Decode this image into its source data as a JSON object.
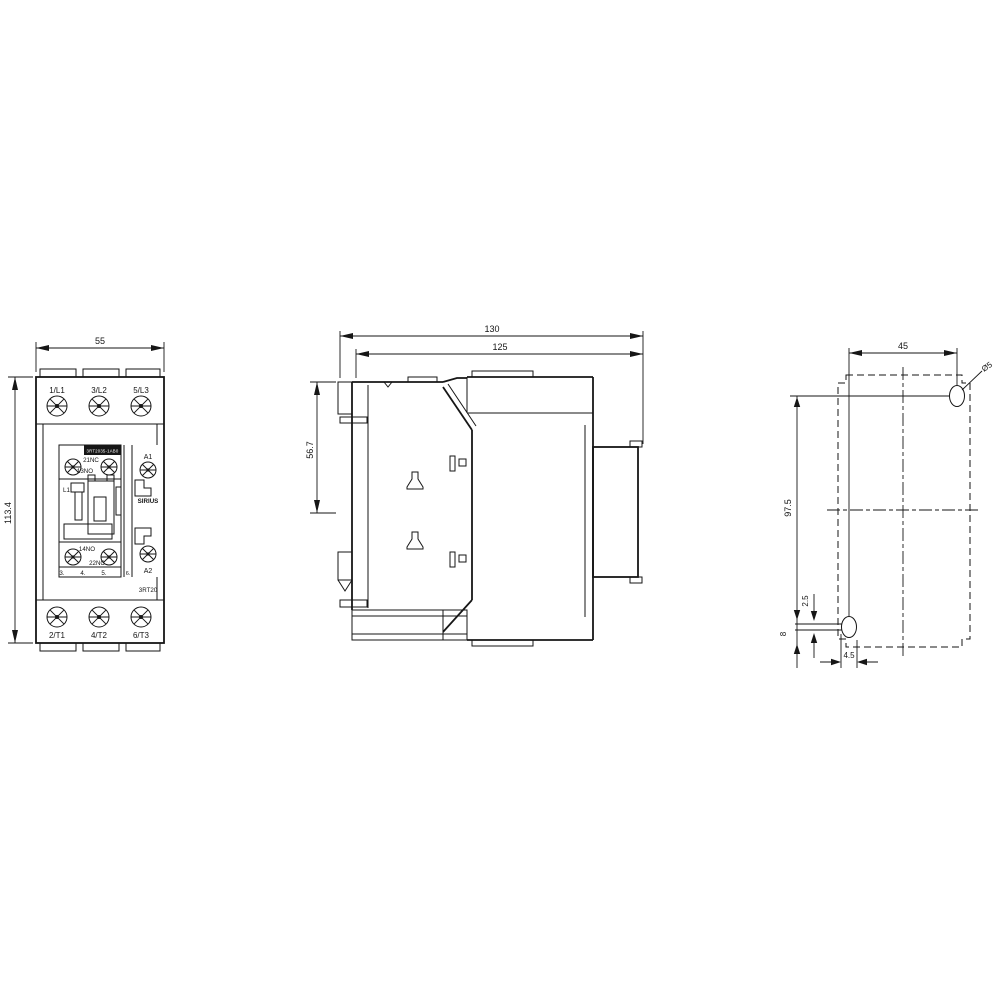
{
  "colors": {
    "line": "#161616",
    "background": "#ffffff"
  },
  "front_view": {
    "width_dim": "55",
    "height_dim": "113.4",
    "top_terminals": [
      "1/L1",
      "3/L2",
      "5/L3"
    ],
    "bottom_terminals": [
      "2/T1",
      "4/T2",
      "6/T3"
    ],
    "aux_top_nc": "21NC",
    "aux_top_no": "13NO",
    "aux_bottom_no": "14NO",
    "aux_bottom_nc": "22NC",
    "coil_tag": "L1",
    "brand": "SIRIUS",
    "series": "3RT20",
    "nameplate": "3RT2035-1AB0",
    "coil_a1": "A1",
    "coil_a2": "A2",
    "scale_marks": [
      "3.",
      "4.",
      "5.",
      "6."
    ]
  },
  "side_view": {
    "depth_overall": "130",
    "depth_inner": "125",
    "din_height": "56.7"
  },
  "drill_view": {
    "spacing_h": "45",
    "spacing_v": "97.5",
    "slot_play": "2.5",
    "slot_length": "8",
    "slot_width": "4.5",
    "hole_dia": "Ø5"
  }
}
